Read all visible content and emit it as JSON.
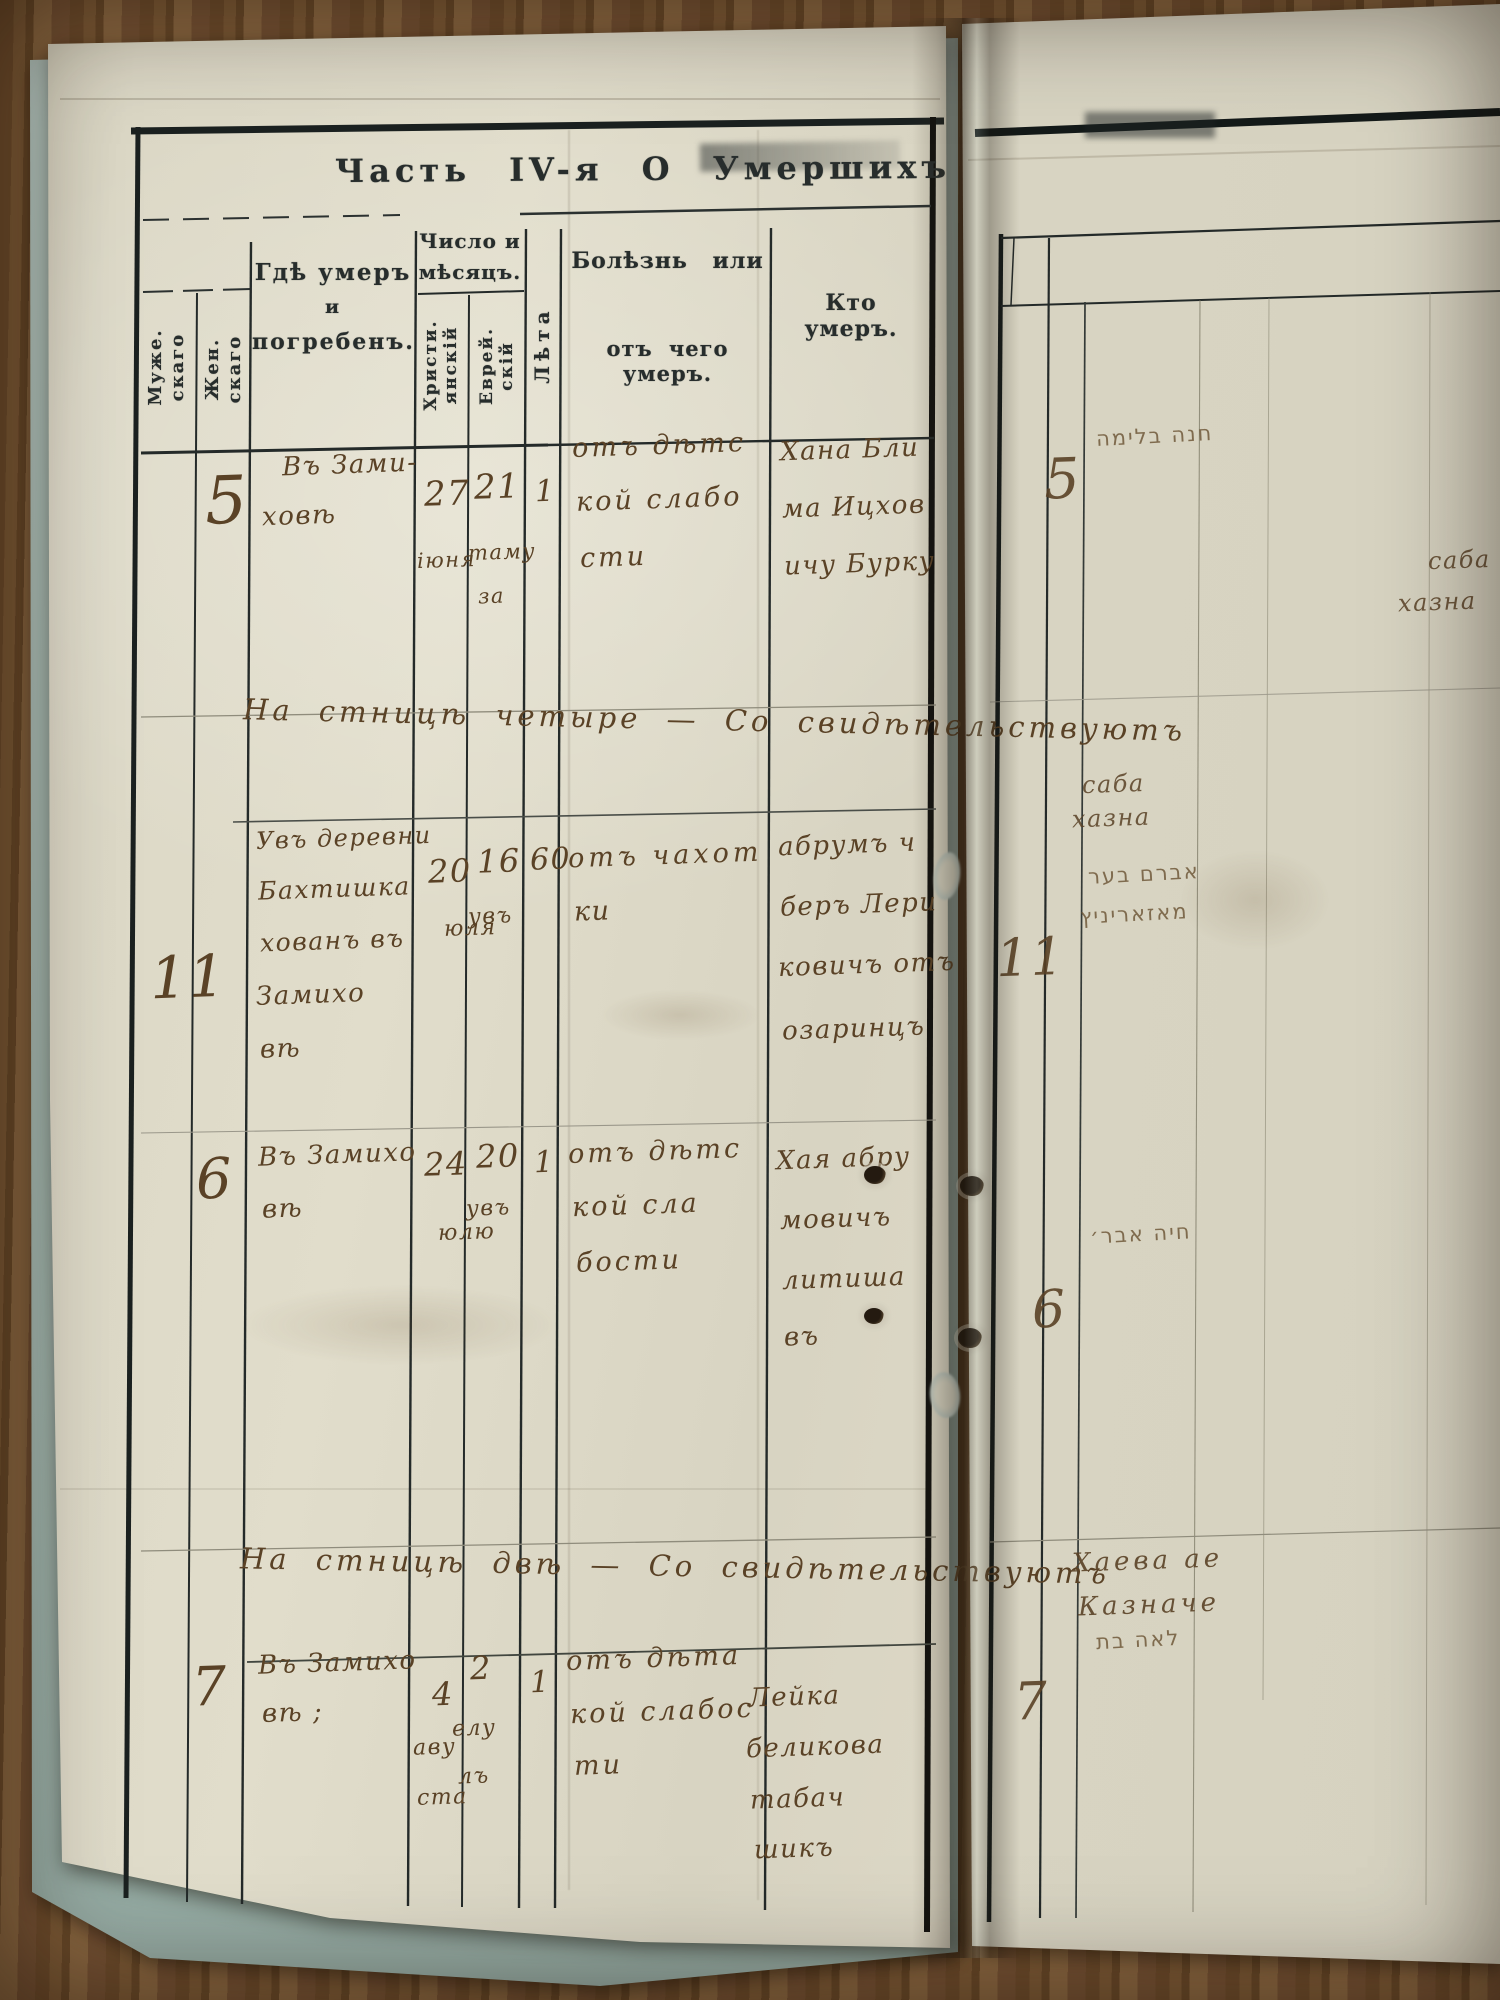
{
  "title": "Часть IV-я  О  Умершихъ",
  "headers": {
    "male": [
      "Муже.",
      "скаго"
    ],
    "female": [
      "Жен.",
      "скаго"
    ],
    "where": [
      "Гдѣ умеръ",
      "и",
      "погребенъ."
    ],
    "date_group": [
      "Число и",
      "мѣсяцъ."
    ],
    "christian": [
      "Христи.",
      "янскій"
    ],
    "jewish": [
      "Еврей.",
      "скій"
    ],
    "age": "Лѣта",
    "illness": [
      "Болѣзнь или",
      "отъ чего умеръ."
    ],
    "who": "Кто умеръ."
  },
  "rows": {
    "r1": {
      "num": "5",
      "where": [
        "Въ Зами-",
        "ховѣ"
      ],
      "christian": [
        "27",
        "іюня"
      ],
      "jewish": [
        "21",
        "таму",
        "за"
      ],
      "age": "1",
      "illness": [
        "отъ дѣтс",
        "кой слабо",
        "сти"
      ],
      "who": [
        "Хана Бли",
        "ма Ицхов",
        "ичу Бурку"
      ]
    },
    "r2": {
      "num": "11",
      "where": [
        "Увъ деревни",
        "Бахтишка",
        "хованъ въ",
        "Замихо",
        "вѣ"
      ],
      "christian": [
        "20",
        "юля"
      ],
      "jewish": [
        "16",
        "увъ"
      ],
      "age": "60",
      "illness": [
        "отъ чахот",
        "ки"
      ],
      "who": [
        "абрумъ ч",
        "беръ Лери",
        "ковичъ отъ",
        "озаринцъ"
      ]
    },
    "r3": {
      "num": "6",
      "where": [
        "Въ Замихо",
        "вѣ"
      ],
      "christian": [
        "24",
        "юлю"
      ],
      "jewish": [
        "20",
        "увъ"
      ],
      "age": "1",
      "illness": [
        "отъ дѣтс",
        "кой сла",
        "бости"
      ],
      "who": [
        "Хая абру",
        "мовичъ",
        "литиша",
        "въ"
      ]
    },
    "r4": {
      "num": "7",
      "where": [
        "Въ Замихо",
        "вѣ ;"
      ],
      "christian": [
        "4",
        "аву",
        "ста"
      ],
      "jewish": [
        "2",
        "елу",
        "лъ"
      ],
      "age": "1",
      "illness": [
        "отъ дѣта",
        "кой слабос",
        "ти"
      ],
      "who": [
        "Лейка",
        "беликова",
        "табач",
        "шикъ"
      ]
    }
  },
  "notes": {
    "attestation1": "На стницѣ четыре — Со свидѣтельствуютъ",
    "attestation2": "На стницѣ двѣ — Со свидѣтельствуютъ"
  },
  "right_page": {
    "numbers": {
      "r1": "5",
      "r2": "11",
      "r3": "6",
      "r4": "7"
    },
    "cursive": {
      "edge1": "саба",
      "edge2": "хазна",
      "mid1": "саба",
      "mid2": "хазна",
      "note1": "Хаева ае",
      "note2": "Казначе"
    },
    "hebrew": {
      "h1": "חנה בלימה",
      "h2a": "אברם בער",
      "h2b": "מאזאריניץ",
      "h3": "חיה אבר׳",
      "h4": "לאה בת"
    }
  }
}
